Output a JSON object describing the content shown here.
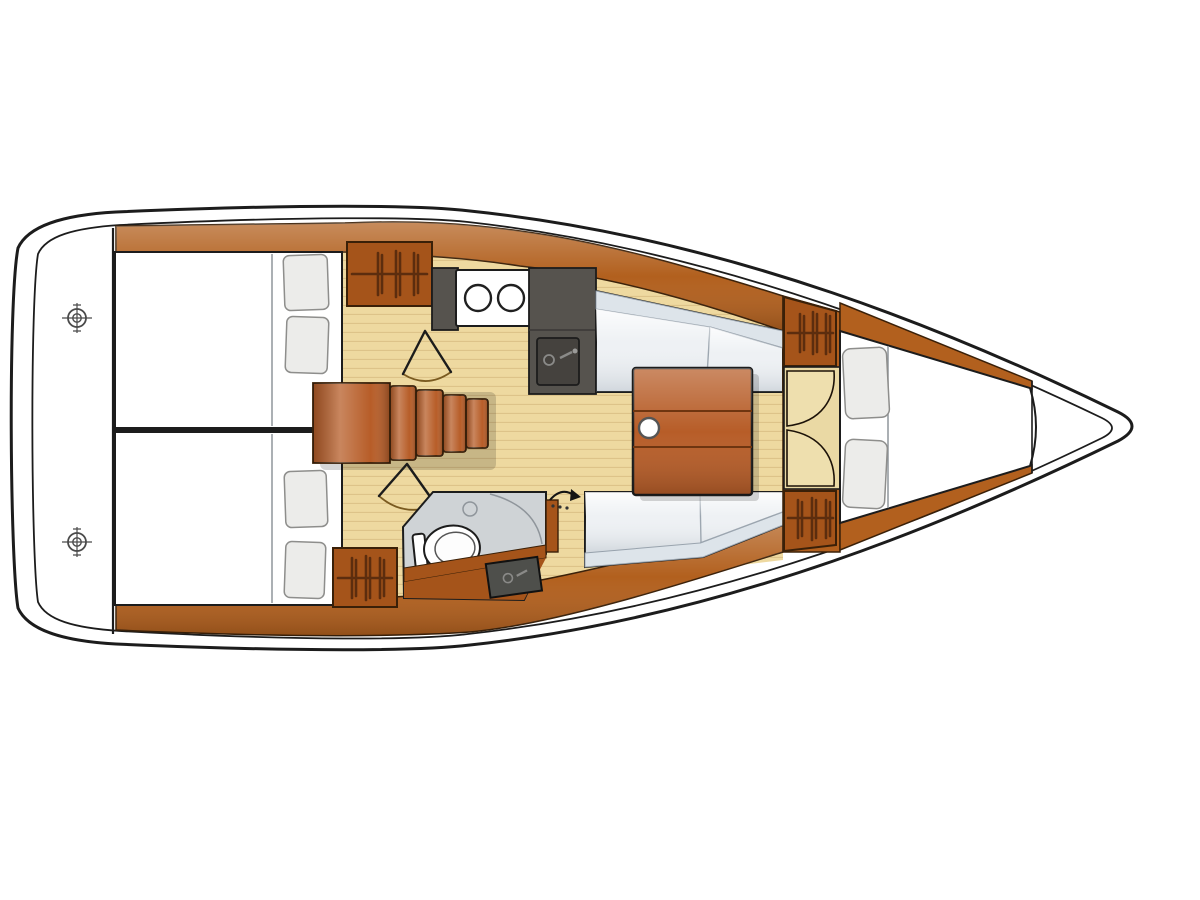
{
  "title": "Sailing yacht interior layout plan, bow pointing right",
  "colors": {
    "background": "#ffffff",
    "white": "#ffffff",
    "hull_outline": "#1c1c1c",
    "wood": "#b2601e",
    "wood_dark": "#a5541a",
    "wood_red": "#b75d28",
    "wood_light": "#cf7d35",
    "wood_edge": "#3a2008",
    "wood_seam": "#6e3510",
    "floor": "#eed9a0",
    "floor_line": "#ddc389",
    "door_tan": "#ead9a4",
    "door_leaf": "#eedfae",
    "counter": "#56534e",
    "sink": "#45423e",
    "cushion": "#eef1f4",
    "cushion_shade": "#dde4ea",
    "cushion_line": "#9aa4ae",
    "pillow": "#ececea",
    "pillow_edge": "#8e8e8c",
    "head_floor": "#cfd3d6",
    "grey_line": "#8f959b",
    "hanger": "#5c2d0e",
    "door_arc": "#7a5a20",
    "winch": "#4a4a4a"
  },
  "plan": {
    "orientation": {
      "bow": "right",
      "stern": "left"
    },
    "areas": [
      {
        "name": "transom-deck",
        "symbols": [
          "winch-icon",
          "winch-icon"
        ]
      },
      {
        "name": "aft-cabin-port",
        "furniture": [
          "double-berth",
          "pillows",
          "hanging-locker",
          "cabin-door"
        ]
      },
      {
        "name": "aft-cabin-starboard",
        "furniture": [
          "double-berth",
          "pillows",
          "hanging-locker",
          "cabin-door"
        ]
      },
      {
        "name": "companionway",
        "furniture": [
          "engine-box",
          "steps"
        ]
      },
      {
        "name": "galley",
        "furniture": [
          "stove-two-burners",
          "counter",
          "sink"
        ]
      },
      {
        "name": "saloon",
        "furniture": [
          "settee-port",
          "settee-starboard",
          "folding-table",
          "mast-post"
        ]
      },
      {
        "name": "head",
        "furniture": [
          "toilet",
          "shower-arc",
          "vanity-sink",
          "sliding-door"
        ]
      },
      {
        "name": "forward-cabin",
        "furniture": [
          "hanging-locker",
          "hanging-locker",
          "double-doors",
          "v-berth",
          "pillows"
        ]
      },
      {
        "name": "bow-locker",
        "furniture": []
      }
    ]
  }
}
